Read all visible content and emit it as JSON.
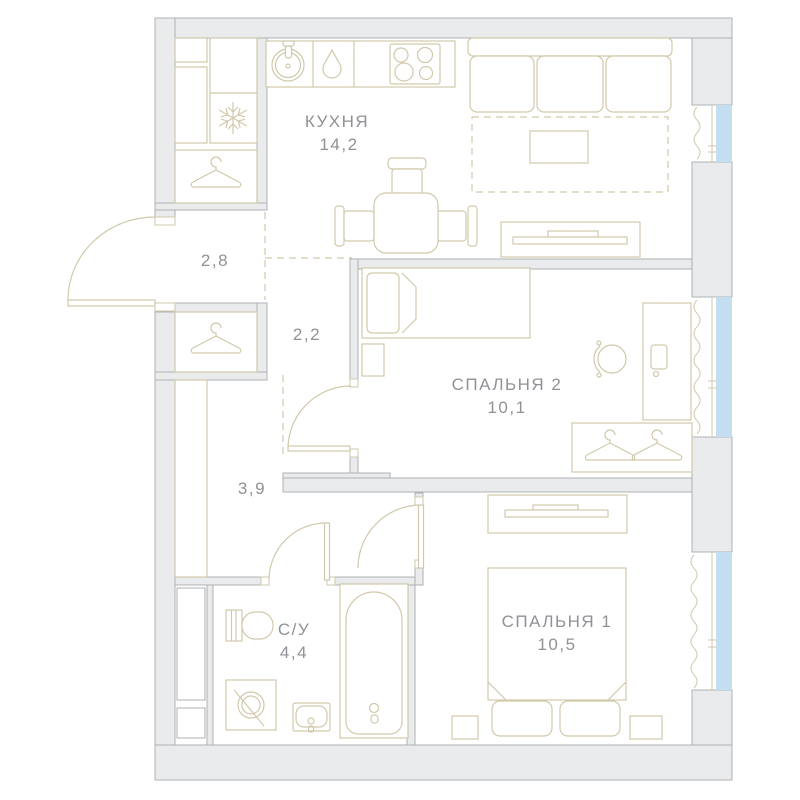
{
  "plan_title": "2-room apartment floor plan",
  "colors": {
    "wall_fill": "#e9ebec",
    "wall_stroke": "#aeb2b4",
    "furniture": "#d1c9ab",
    "window_fill": "#c3ddf1",
    "text_color": "#8f9296"
  },
  "rooms": [
    {
      "id": "kitchen",
      "name": "КУХНЯ",
      "area": "14,2"
    },
    {
      "id": "bedroom2",
      "name": "СПАЛЬНЯ 2",
      "area": "10,1"
    },
    {
      "id": "bedroom1",
      "name": "СПАЛЬНЯ 1",
      "area": "10,5"
    },
    {
      "id": "bathroom",
      "name": "С/У",
      "area": "4,4"
    },
    {
      "id": "hallway",
      "name": "",
      "area": "2,8"
    },
    {
      "id": "corridor",
      "name": "",
      "area": "2,2"
    },
    {
      "id": "corridor2",
      "name": "",
      "area": "3,9"
    }
  ],
  "fixtures": [
    "kitchen-sink",
    "dishwasher-drop",
    "stove-4-burners",
    "fridge-snowflake",
    "hanger-closet",
    "dining-table",
    "chair",
    "sofa",
    "rug-dashed",
    "coffee-table",
    "tv-stand",
    "tv",
    "single-bed",
    "nightstand",
    "desk",
    "desk-chair",
    "wardrobe-2-hangers",
    "double-bed",
    "pillows",
    "toilet",
    "washing-machine",
    "washbasin",
    "bathtub",
    "entrance-door",
    "interior-door",
    "window",
    "curtain"
  ],
  "window_count": "3"
}
